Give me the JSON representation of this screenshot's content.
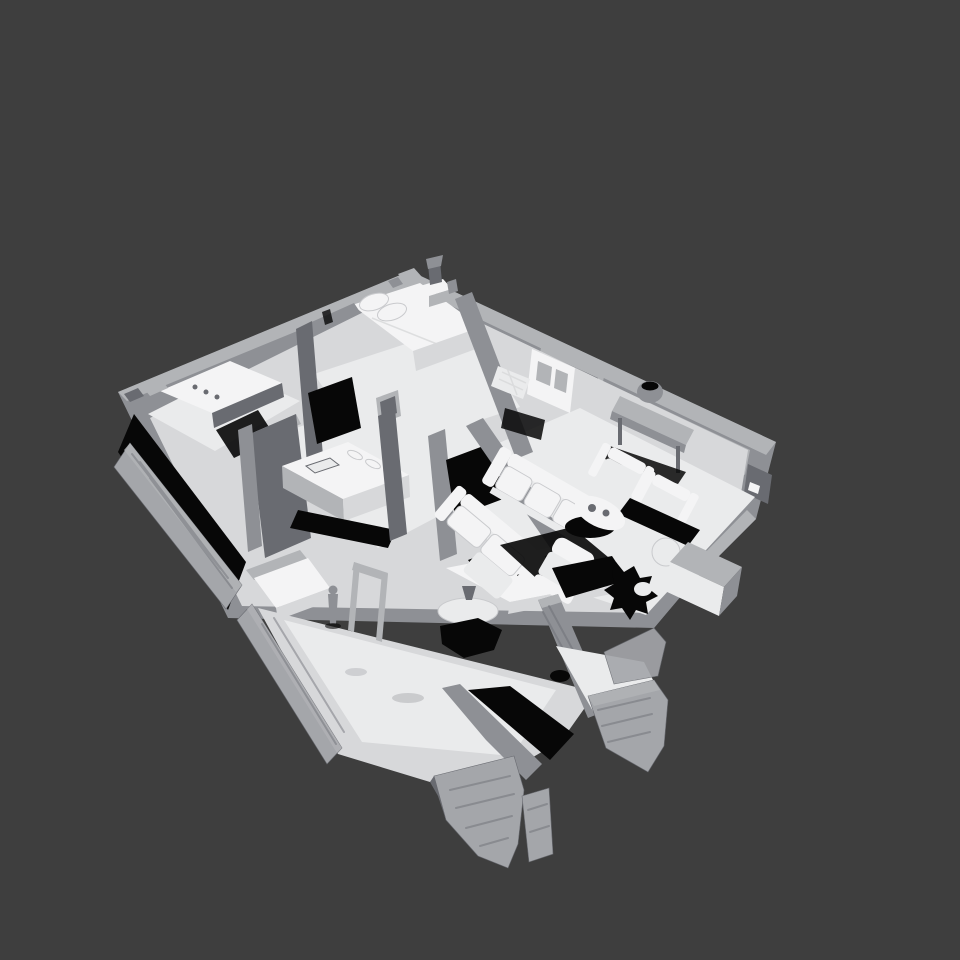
{
  "viewport": {
    "background_color": "#3e3e3e",
    "content": "Untextured grayscale 3D mesh scan of a furnished single-story home interior, viewed from above at an oblique angle",
    "render_style": "flat-shaded mesh, light from upper-left, hard black shadows, ragged unscanned wall edges"
  },
  "palette": {
    "background": "#3e3e3e",
    "floor": "#d7d8da",
    "floor_bright": "#eaebec",
    "furniture_white": "#f4f4f5",
    "wall_light": "#b2b4b7",
    "wall_mid": "#8e9095",
    "wall_dark": "#696b71",
    "rough_wall": "#a4a6aa",
    "shadow": "#070707"
  },
  "scene_objects": [
    "house-scan-mesh",
    "bathroom-vanity",
    "toilet",
    "bedroom-bed",
    "pillows",
    "nightstand",
    "table-lamp",
    "wall-mirror",
    "paneled-door",
    "crib-bed",
    "wall-picture-frame",
    "kitchen-island",
    "island-items",
    "tall-cabinet",
    "dining-counter",
    "counter-clutter",
    "houseplant",
    "sofa",
    "loveseat",
    "armchair-pair",
    "round-coffee-table",
    "console-table",
    "ceramic-pot",
    "window-frames",
    "recliner",
    "ottoman",
    "exterior-unit-box",
    "patio-room",
    "curtain-wall",
    "glass-door-frame",
    "standing-figure",
    "pedestal-table",
    "floor-hole",
    "rough-scan-walls"
  ]
}
